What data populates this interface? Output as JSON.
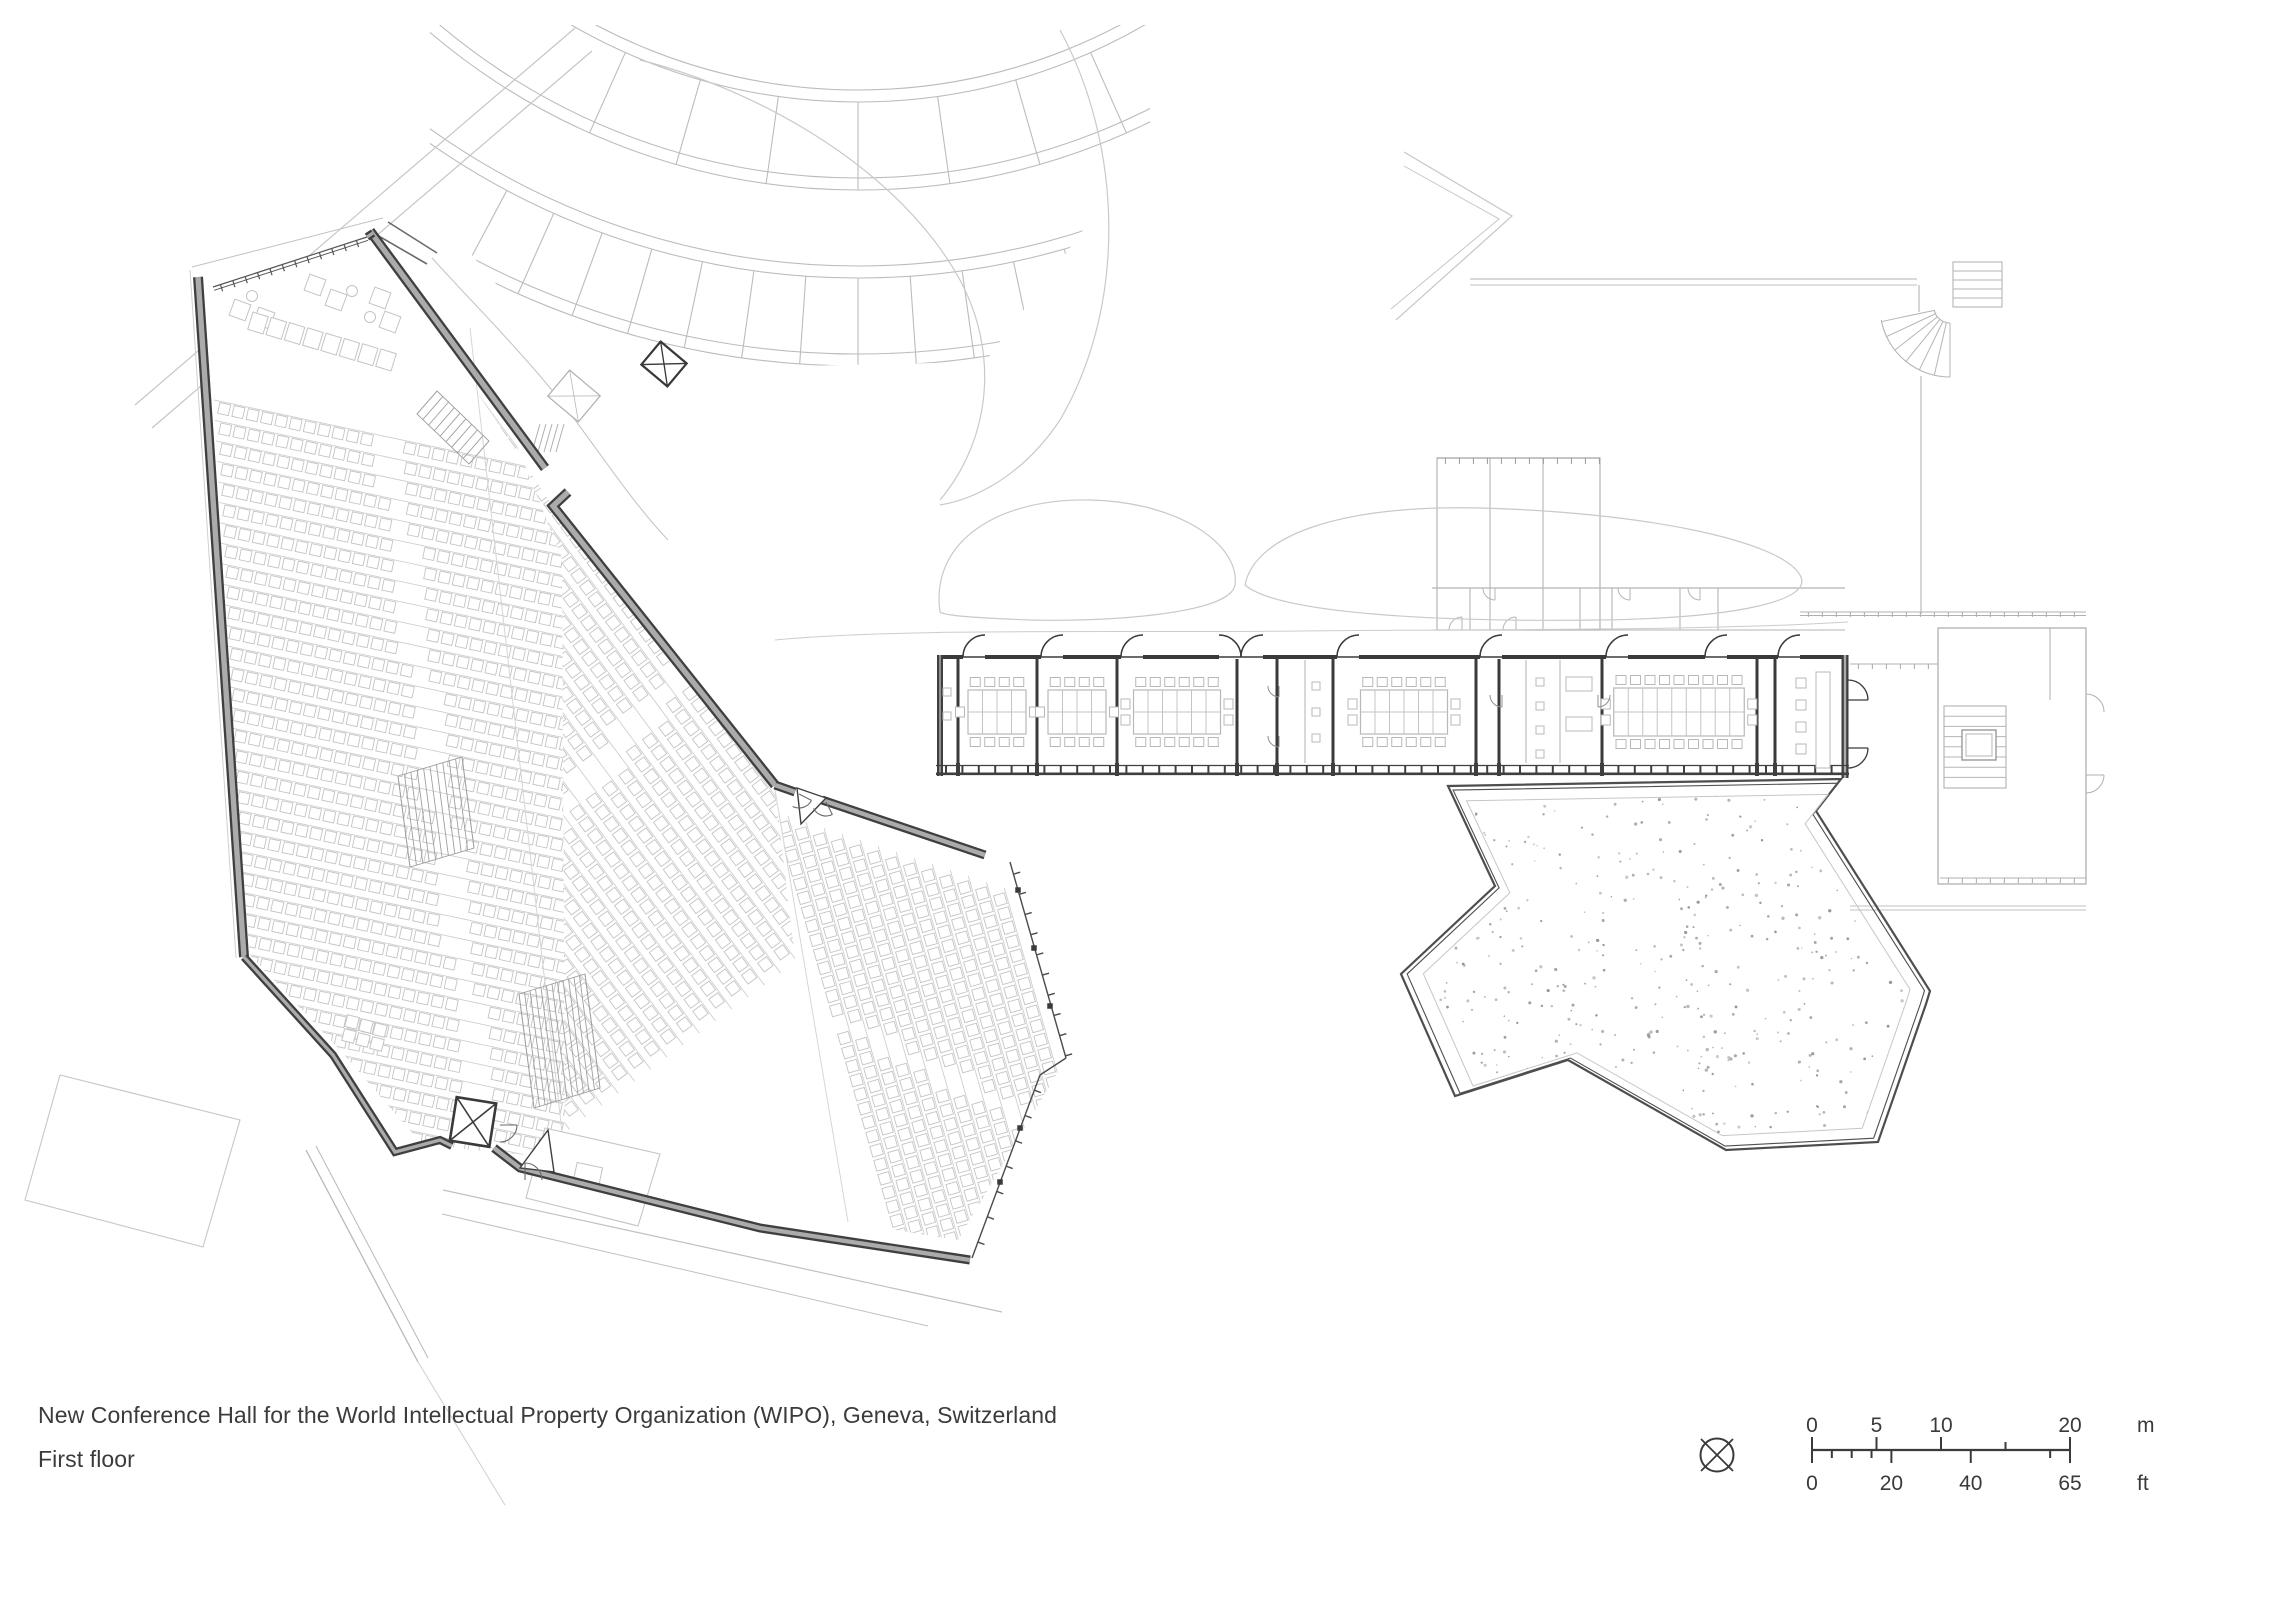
{
  "caption": {
    "line1": "New Conference Hall for the World Intellectual Property Organization (WIPO), Geneva, Switzerland",
    "line2": "First floor"
  },
  "scale_bar": {
    "meters": {
      "unit_label": "m",
      "max": 20,
      "ticks": [
        {
          "value": 0,
          "label": "0"
        },
        {
          "value": 5,
          "label": "5"
        },
        {
          "value": 10,
          "label": "10"
        },
        {
          "value": 15,
          "label": ""
        },
        {
          "value": 20,
          "label": "20"
        }
      ]
    },
    "feet": {
      "unit_label": "ft",
      "max": 65,
      "ticks": [
        {
          "value": 0,
          "label": "0"
        },
        {
          "value": 5,
          "label": ""
        },
        {
          "value": 10,
          "label": ""
        },
        {
          "value": 15,
          "label": ""
        },
        {
          "value": 20,
          "label": "20"
        },
        {
          "value": 40,
          "label": "40"
        },
        {
          "value": 60,
          "label": ""
        },
        {
          "value": 65,
          "label": "65"
        }
      ]
    }
  },
  "north_symbol": {
    "icon": "north-orientation-icon"
  },
  "colors": {
    "paper": "#ffffff",
    "ink": "#3a3a3a",
    "wall_dark": "#3f3f3f",
    "wall_core": "#ababab",
    "light_line": "#c6c6c6",
    "mid_line": "#9a9a9a",
    "seat_line": "#c4c4c4",
    "stipple": "#8f8f8f"
  }
}
